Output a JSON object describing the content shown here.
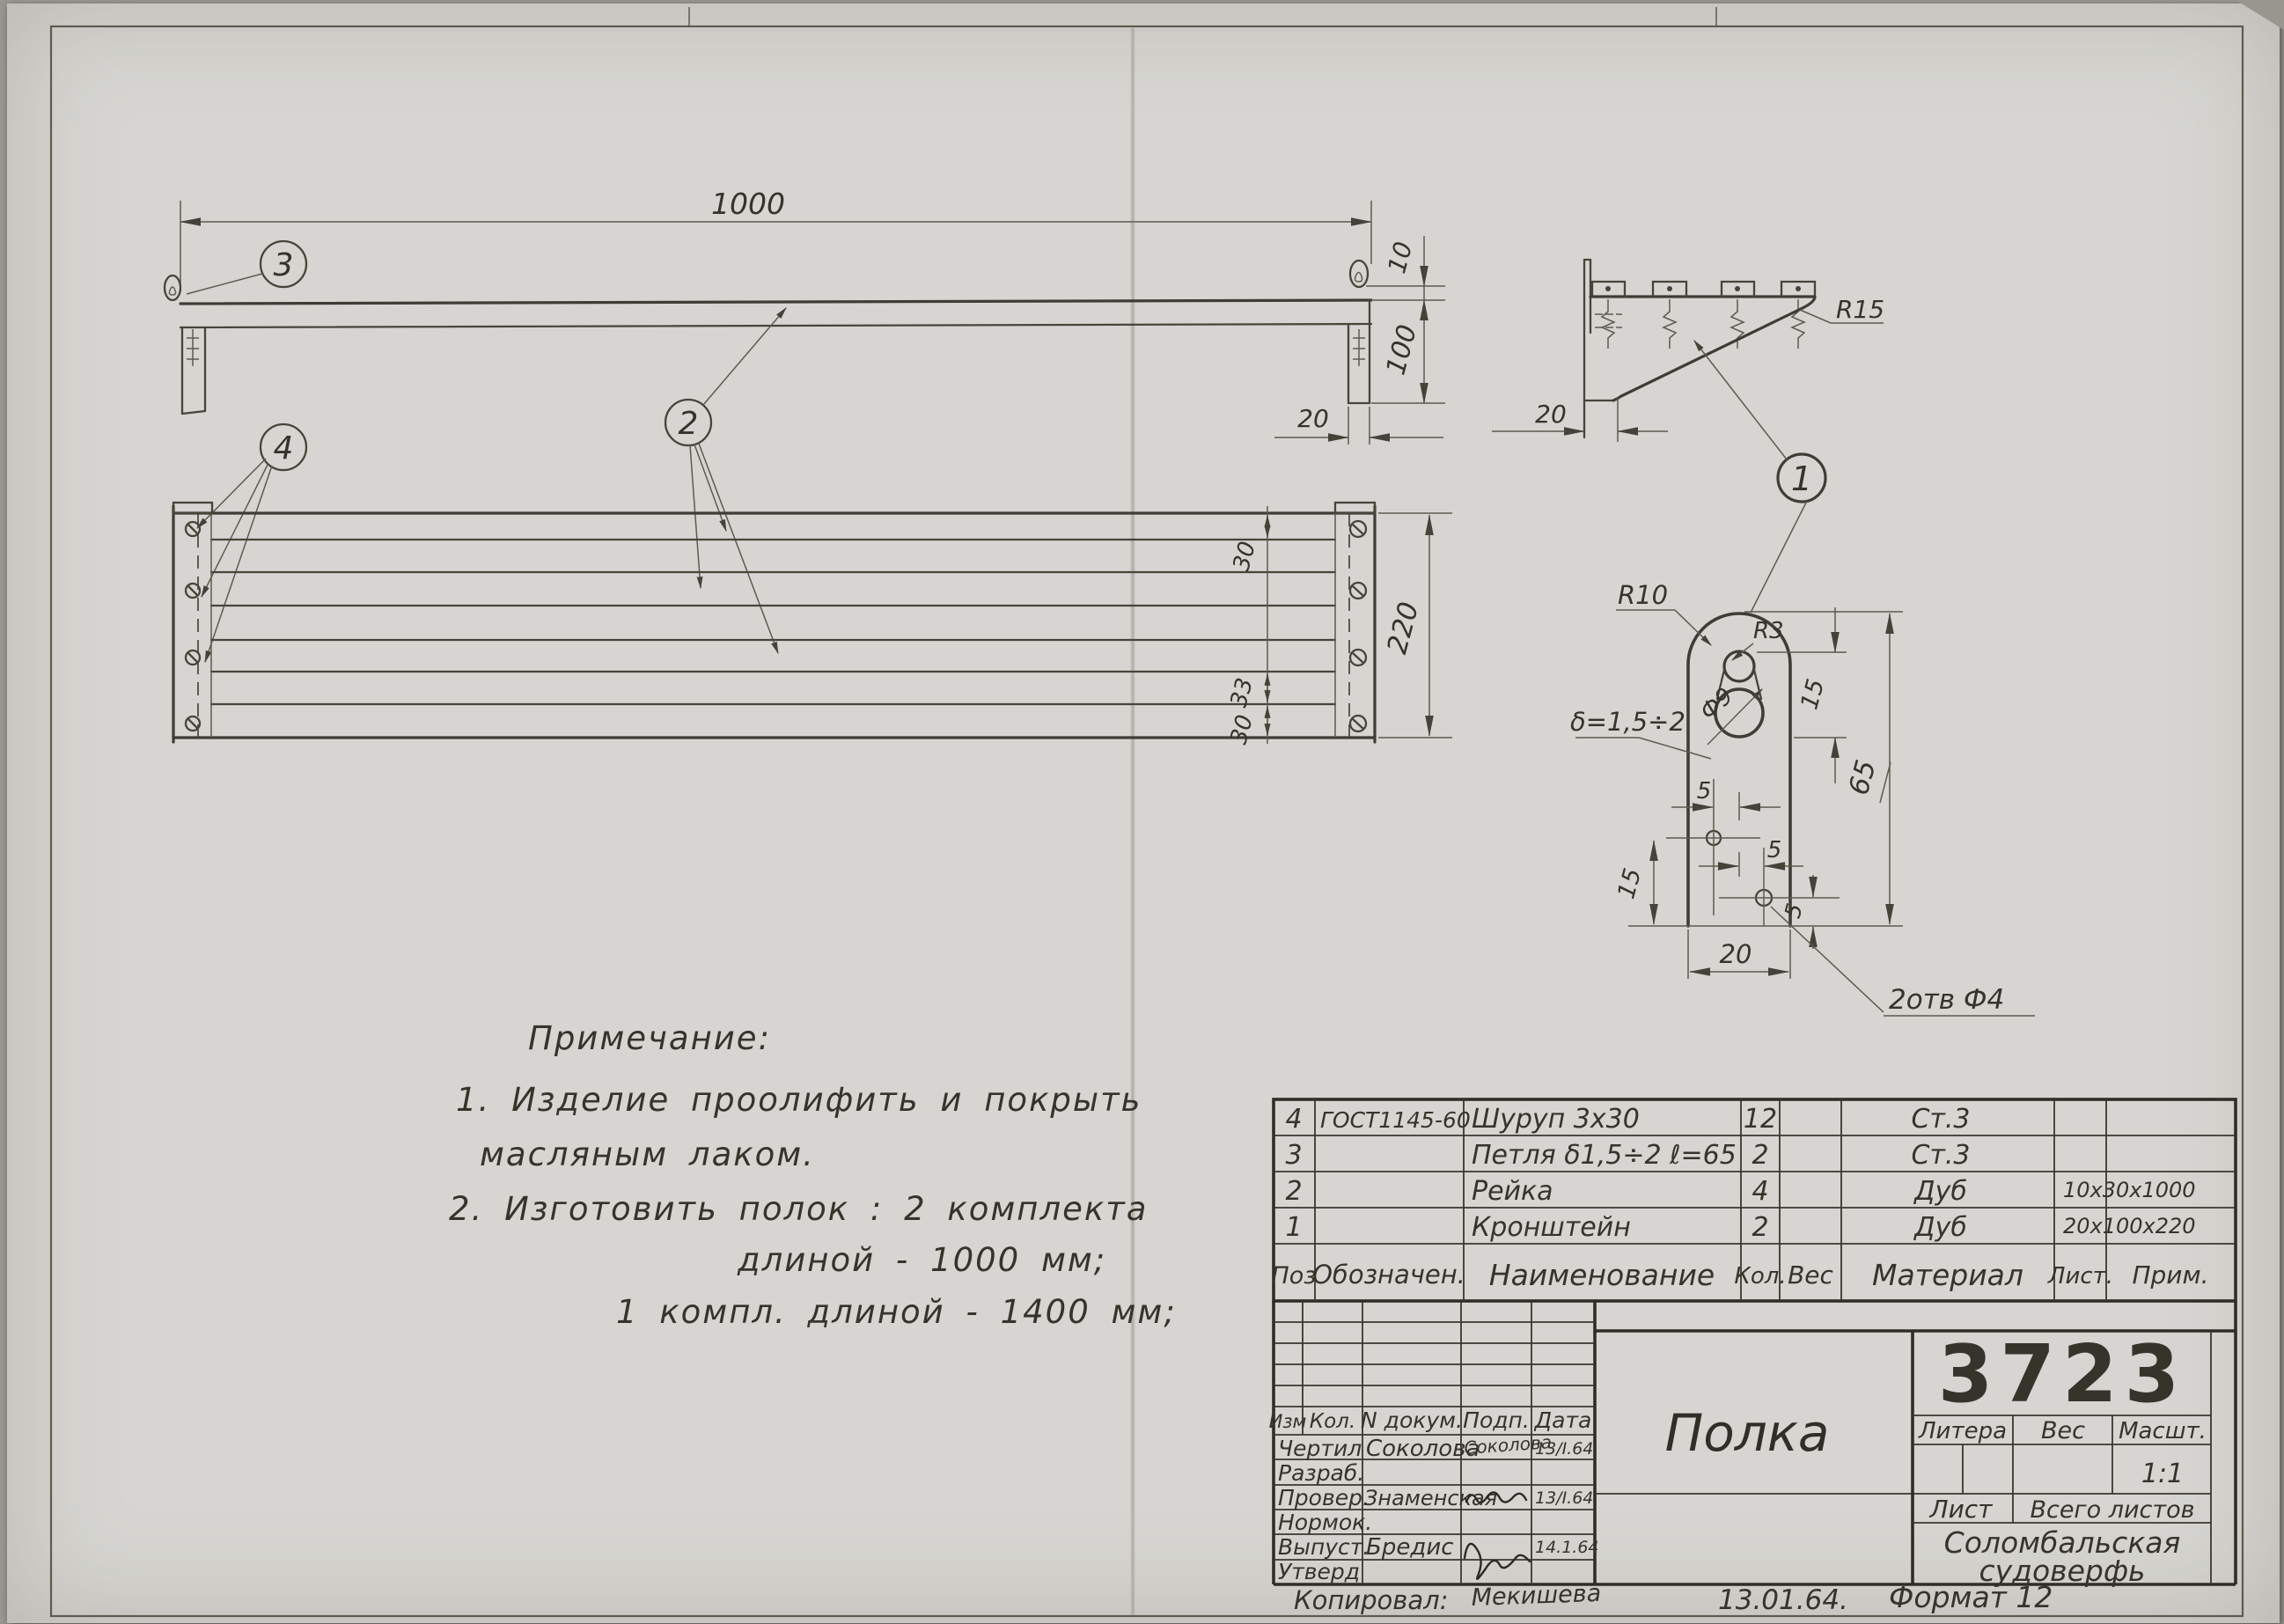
{
  "sheet": {
    "drawing_number": "3723",
    "product_title": "Полка",
    "scale_value": "1:1",
    "org_line1": "Соломбальская",
    "org_line2": "судоверфь",
    "format_note": "Формат 12",
    "copy_date": "13.01.64.",
    "copied_label": "Копировал:",
    "copied_signature": "Мекишева"
  },
  "balloons": {
    "b1": "1",
    "b2": "2",
    "b3": "3",
    "b4": "4"
  },
  "front_view": {
    "dim_length": "1000",
    "dim_10": "10",
    "dim_100": "100",
    "dim_20": "20"
  },
  "plan_view": {
    "dim_30_top": "30",
    "dim_33": "33",
    "dim_30_bottom": "30",
    "dim_220": "220"
  },
  "side_view": {
    "r15": "R15",
    "dim_20": "20"
  },
  "detail_view": {
    "r10": "R10",
    "r3": "R3",
    "f9": "Ф9",
    "delta": "δ=1,5÷2",
    "dim_15_top": "15",
    "dim_65": "65",
    "dim_5_left": "5",
    "dim_15_left": "15",
    "dim_5_right": "5",
    "dim_5_bottom": "5",
    "dim_20": "20",
    "holes_note": "2отв Ф4"
  },
  "notes": {
    "heading": "Примечание:",
    "line1": "1. Изделие  проолифить  и  покрыть",
    "line2": "масляным  лаком.",
    "line3": "2. Изготовить  полок :  2 комплекта",
    "line4": "длиной  - 1000 мм;",
    "line5": "1 компл.  длиной  - 1400 мм;"
  },
  "parts_table": {
    "headers": {
      "pos": "Поз",
      "designation": "Обозначен.",
      "name": "Наименование",
      "qty": "Кол.",
      "weight": "Вес",
      "material": "Материал",
      "sheet": "Лист.",
      "note": "Прим."
    },
    "rows": [
      {
        "pos": "4",
        "designation": "ГОСТ1145-60",
        "name": "Шуруп 3х30",
        "qty": "12",
        "weight": "",
        "material": "Ст.3",
        "sheet": "",
        "note": ""
      },
      {
        "pos": "3",
        "designation": "",
        "name": "Петля δ1,5÷2 ℓ=65",
        "qty": "2",
        "weight": "",
        "material": "Ст.3",
        "sheet": "",
        "note": ""
      },
      {
        "pos": "2",
        "designation": "",
        "name": "Рейка",
        "qty": "4",
        "weight": "",
        "material": "Дуб",
        "sheet": "",
        "note": "10х30х1000"
      },
      {
        "pos": "1",
        "designation": "",
        "name": "Кронштейн",
        "qty": "2",
        "weight": "",
        "material": "Дуб",
        "sheet": "",
        "note": "20х100х220"
      }
    ]
  },
  "title_block": {
    "rev_headers": [
      "Изм",
      "Кол.",
      "N докум.",
      "Подп.",
      "Дата"
    ],
    "sign_rows": [
      {
        "role": "Чертил",
        "name": "Соколова",
        "sig": "Соколова",
        "date": "13/I.64"
      },
      {
        "role": "Разраб.",
        "name": "",
        "sig": "",
        "date": ""
      },
      {
        "role": "Провер.",
        "name": "Знаменская",
        "sig": "",
        "date": "13/I.64"
      },
      {
        "role": "Нормок.",
        "name": "",
        "sig": "",
        "date": ""
      },
      {
        "role": "Выпуст.",
        "name": "Бредис",
        "sig": "",
        "date": "14.1.64"
      },
      {
        "role": "Утверд",
        "name": "",
        "sig": "",
        "date": ""
      }
    ],
    "litera_label": "Литера",
    "ves_label": "Вес",
    "masht_label": "Масшт.",
    "list_label": "Лист",
    "vsego_label": "Всего листов"
  }
}
